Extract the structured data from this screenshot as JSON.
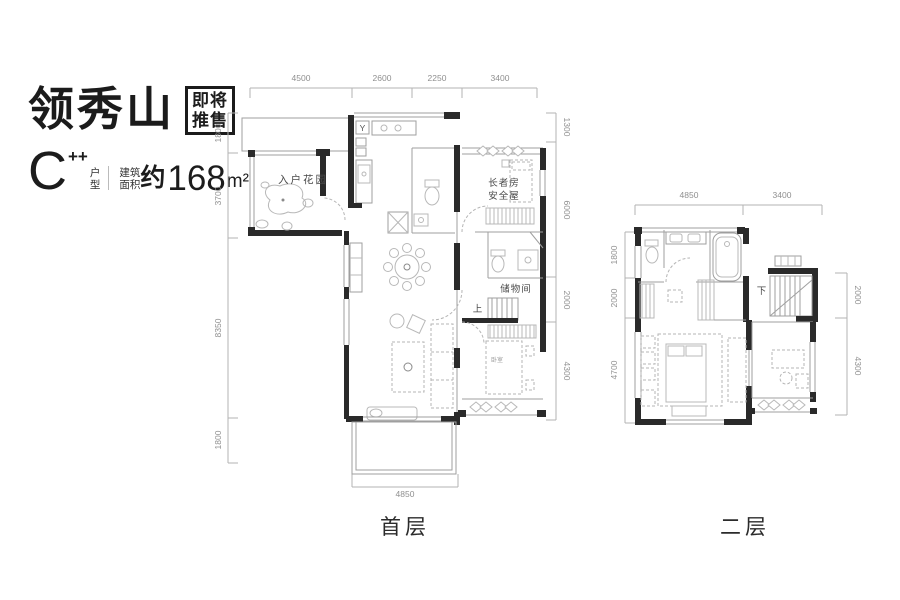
{
  "header": {
    "brand": "领秀山",
    "badge_line1": "即将",
    "badge_line2": "推售",
    "unit": "C",
    "unit_sup": "++",
    "unit_label_line1": "户",
    "unit_label_line2": "型",
    "area_label_line1": "建筑",
    "area_label_line2": "面积",
    "area_about": "约",
    "area_value": "168",
    "area_unit": "m²"
  },
  "floor1": {
    "name": "首层",
    "dims_top": [
      "4500",
      "2600",
      "2250",
      "3400"
    ],
    "dims_left": [
      "1800",
      "3700",
      "8350",
      "1800"
    ],
    "dims_right": [
      "1300",
      "6000",
      "2000",
      "4300"
    ],
    "dim_bottom": "4850",
    "rooms": {
      "garden": "入户花园",
      "elder_line1": "长者房",
      "elder_line2": "安全屋",
      "storage": "储物间",
      "bedroom": "卧室",
      "stair_up": "上",
      "meter": "Y"
    }
  },
  "floor2": {
    "name": "二层",
    "dims_top": [
      "4850",
      "3400"
    ],
    "dims_left": [
      "1800",
      "2000",
      "4700"
    ],
    "dims_right": [
      "2000",
      "4300"
    ],
    "stair_down": "下"
  },
  "colors": {
    "wall": "#2a2a2a",
    "furniture_line": "#b8b8b8",
    "dimension": "#8f8f8f",
    "brand_text": "#1b1b1b"
  }
}
